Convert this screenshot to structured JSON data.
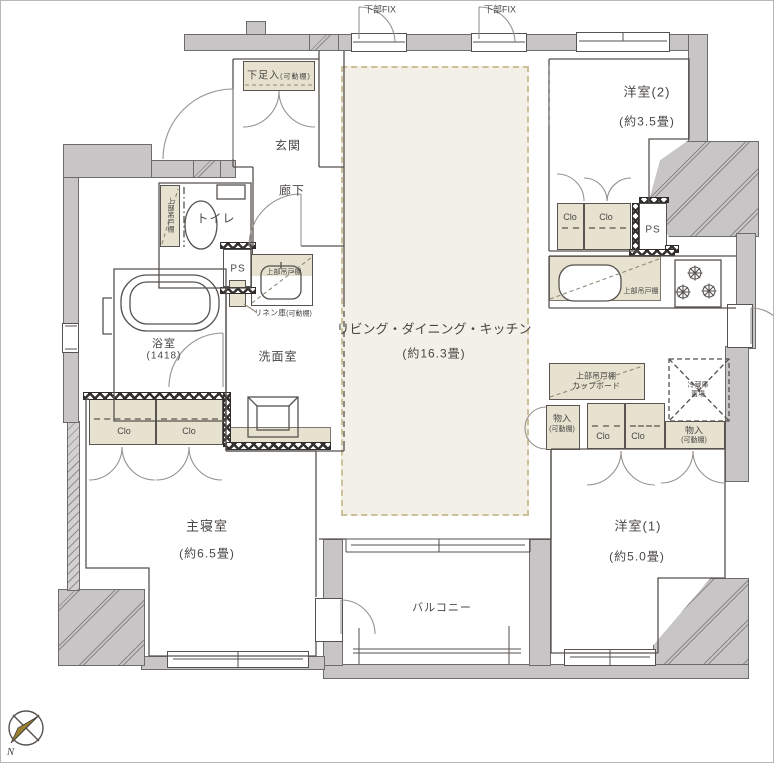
{
  "plan": {
    "openings": {
      "fix1": "下部FIX",
      "fix2": "下部FIX"
    },
    "entrance": {
      "name": "玄関",
      "shoe_box": "下足入",
      "shoe_box_note": "(可動棚)"
    },
    "hallway": {
      "name": "廊下"
    },
    "toilet": {
      "name": "トイレ",
      "shelf": "上部吊戸棚"
    },
    "bathroom": {
      "name": "浴室",
      "size": "(1418)"
    },
    "washroom": {
      "name": "洗面室",
      "shelf": "上部吊戸棚",
      "linen": "リネン庫",
      "linen_note": "(可動棚)"
    },
    "pipe_spaces": {
      "ps1": "PS",
      "ps2": "PS"
    },
    "master_bedroom": {
      "name": "主寝室",
      "size": "(約6.5畳)",
      "closet1": "Clo",
      "closet2": "Clo"
    },
    "ldk": {
      "name": "リビング・ダイニング・キッチン",
      "size": "(約16.3畳)",
      "kitchen_shelf": "上部吊戸棚",
      "fridge_line1": "冷蔵庫",
      "fridge_line2": "置場",
      "cupboard_line1": "上部吊戸棚",
      "cupboard_line2": "カップボード"
    },
    "room2": {
      "name": "洋室(2)",
      "size": "(約3.5畳)",
      "closet1": "Clo",
      "closet2": "Clo"
    },
    "room1": {
      "name": "洋室(1)",
      "size": "(約5.0畳)",
      "closet1": "Clo",
      "closet2": "Clo",
      "storage1": "物入",
      "storage1_note": "(可動棚)",
      "storage2": "物入",
      "storage2_note": "(可動棚)"
    },
    "balcony": {
      "name": "バルコニー"
    },
    "compass": {
      "north": "N"
    },
    "colors": {
      "wall": "#c7c5c5",
      "storage": "#e7e1cf",
      "ldk_area": "#f3f0e7",
      "line": "#56524e",
      "tatami_dash": "#cdbf97"
    }
  }
}
